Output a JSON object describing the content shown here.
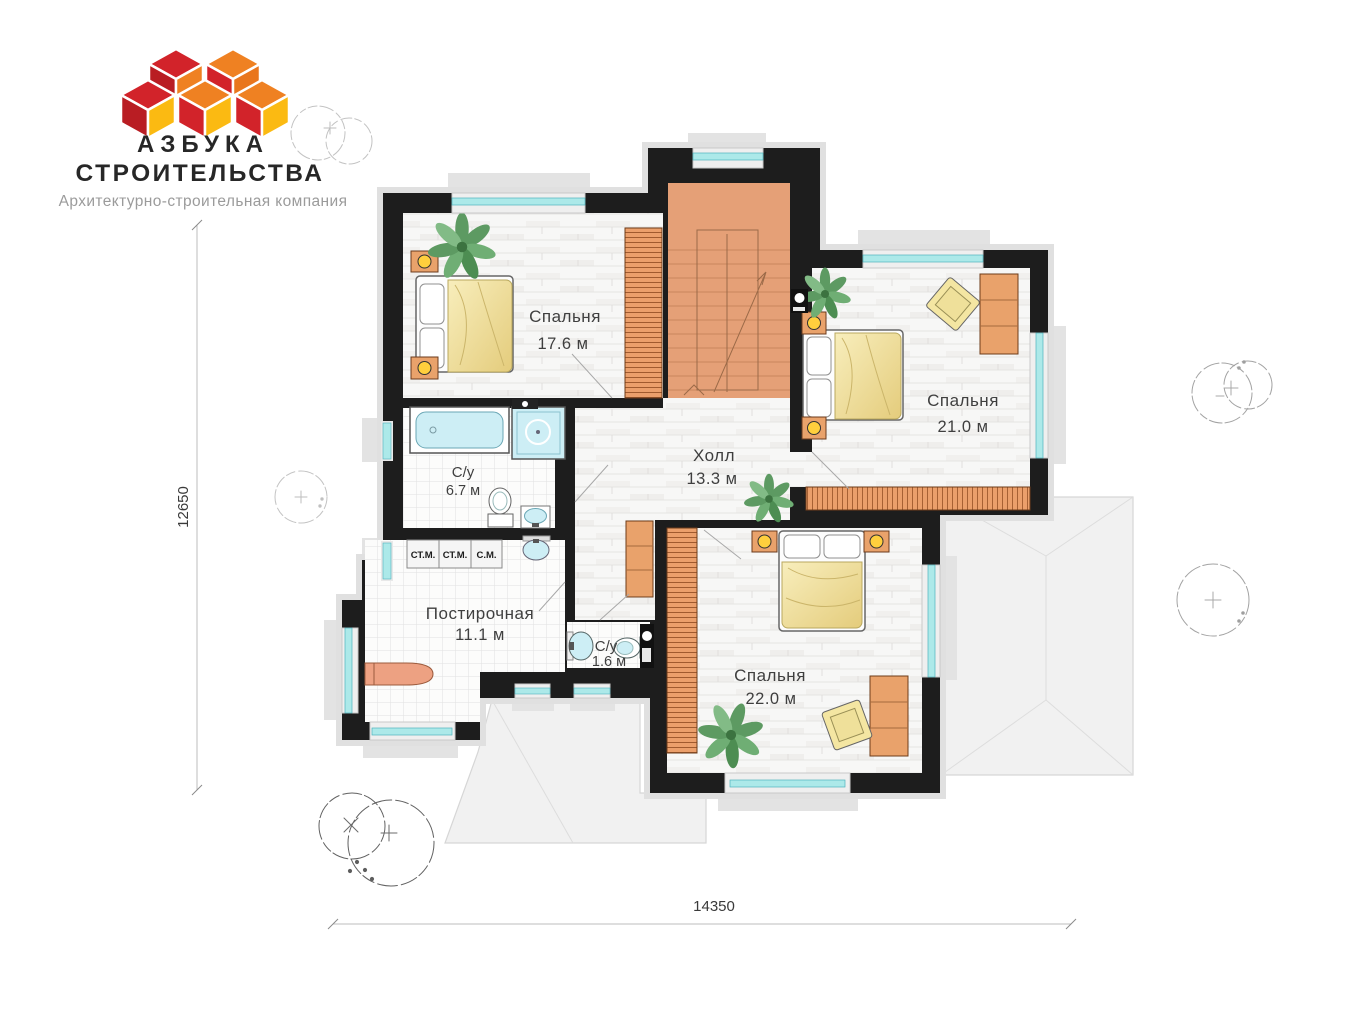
{
  "logo": {
    "title_line1": "АЗБУКА",
    "title_line2": "СТРОИТЕЛЬСТВА",
    "subtitle": "Архитектурно-строительная компания",
    "colors": {
      "red": "#d2232a",
      "dark_red": "#b91d23",
      "orange": "#ef8122",
      "yellow": "#fbba12"
    }
  },
  "plan": {
    "rooms": [
      {
        "name": "Спальня",
        "area": "17.6 м"
      },
      {
        "name": "Спальня",
        "area": "21.0 м"
      },
      {
        "name": "Холл",
        "area": "13.3 м"
      },
      {
        "name": "С/у",
        "area": "6.7 м"
      },
      {
        "name": "Постирочная",
        "area": "11.1 м"
      },
      {
        "name": "С/у",
        "area": "1.6 м"
      },
      {
        "name": "Спальня",
        "area": "22.0 м"
      }
    ],
    "appliances": [
      "СТ.М.",
      "СТ.М.",
      "С.М."
    ],
    "dimensions": {
      "width": "14350",
      "height": "12650"
    },
    "colors": {
      "wall": "#1d1d1d",
      "stairs": "#e5a077",
      "furniture_wood": "#e9a26b",
      "window_glass": "#ace9e9",
      "blanket": "#efdf9d",
      "roof": "#f1f1f1",
      "plant": "#4d8d52"
    }
  }
}
